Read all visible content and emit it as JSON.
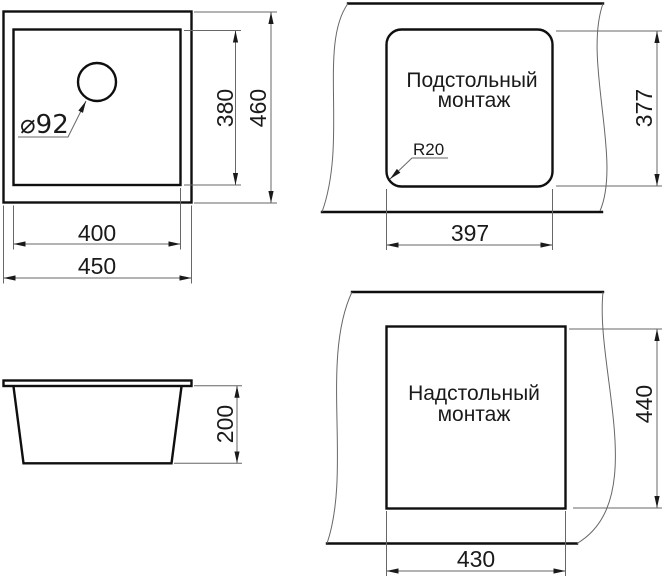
{
  "drawing": {
    "type": "sink-installation-dimensions",
    "colors": {
      "object_line": "#0f0f0f",
      "dimension_line": "#676767",
      "text": "#1a1a1a",
      "background": "#ffffff"
    },
    "plan_view": {
      "outer_width": "450",
      "inner_width": "400",
      "inner_height": "380",
      "outer_height": "460",
      "drain_diameter": "⌀92"
    },
    "side_view": {
      "height": "200"
    },
    "undermount_view": {
      "label_line1": "Подстольный",
      "label_line2": "монтаж",
      "corner_radius": "R20",
      "cutout_width": "397",
      "cutout_height": "377"
    },
    "topmount_view": {
      "label_line1": "Надстольный",
      "label_line2": "монтаж",
      "cutout_width": "430",
      "cutout_height": "440"
    }
  }
}
